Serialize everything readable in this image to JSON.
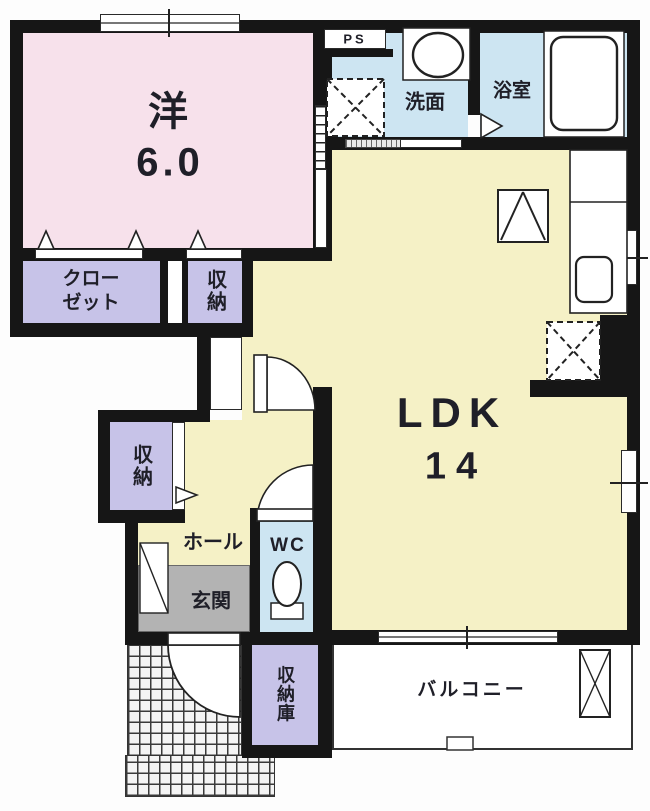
{
  "plan_title": "1LDK apartment floor plan",
  "colors": {
    "wall": "#161616",
    "western_room": "#f7e1eb",
    "ldk": "#f5f1c6",
    "storage": "#c7c3e8",
    "wet_area": "#cde5f2",
    "entrance": "#b3b3b3",
    "balcony": "#ffffff"
  },
  "rooms": {
    "western_room": {
      "label": "洋",
      "size": "6.0"
    },
    "ldk": {
      "label": "LDK",
      "size": "14"
    },
    "closet": {
      "line1": "クロー",
      "line2": "ゼット"
    },
    "storage_upper": {
      "label": "収納"
    },
    "storage_hall": {
      "label": "収納"
    },
    "hall": {
      "label": "ホール"
    },
    "entrance": {
      "label": "玄関"
    },
    "wc": {
      "label": "WC"
    },
    "washroom": {
      "label": "洗面"
    },
    "bathroom": {
      "label": "浴室"
    },
    "pipe_space": {
      "label": "PS"
    },
    "storage_room": {
      "label": "収納庫"
    },
    "balcony": {
      "label": "バルコニー"
    }
  }
}
